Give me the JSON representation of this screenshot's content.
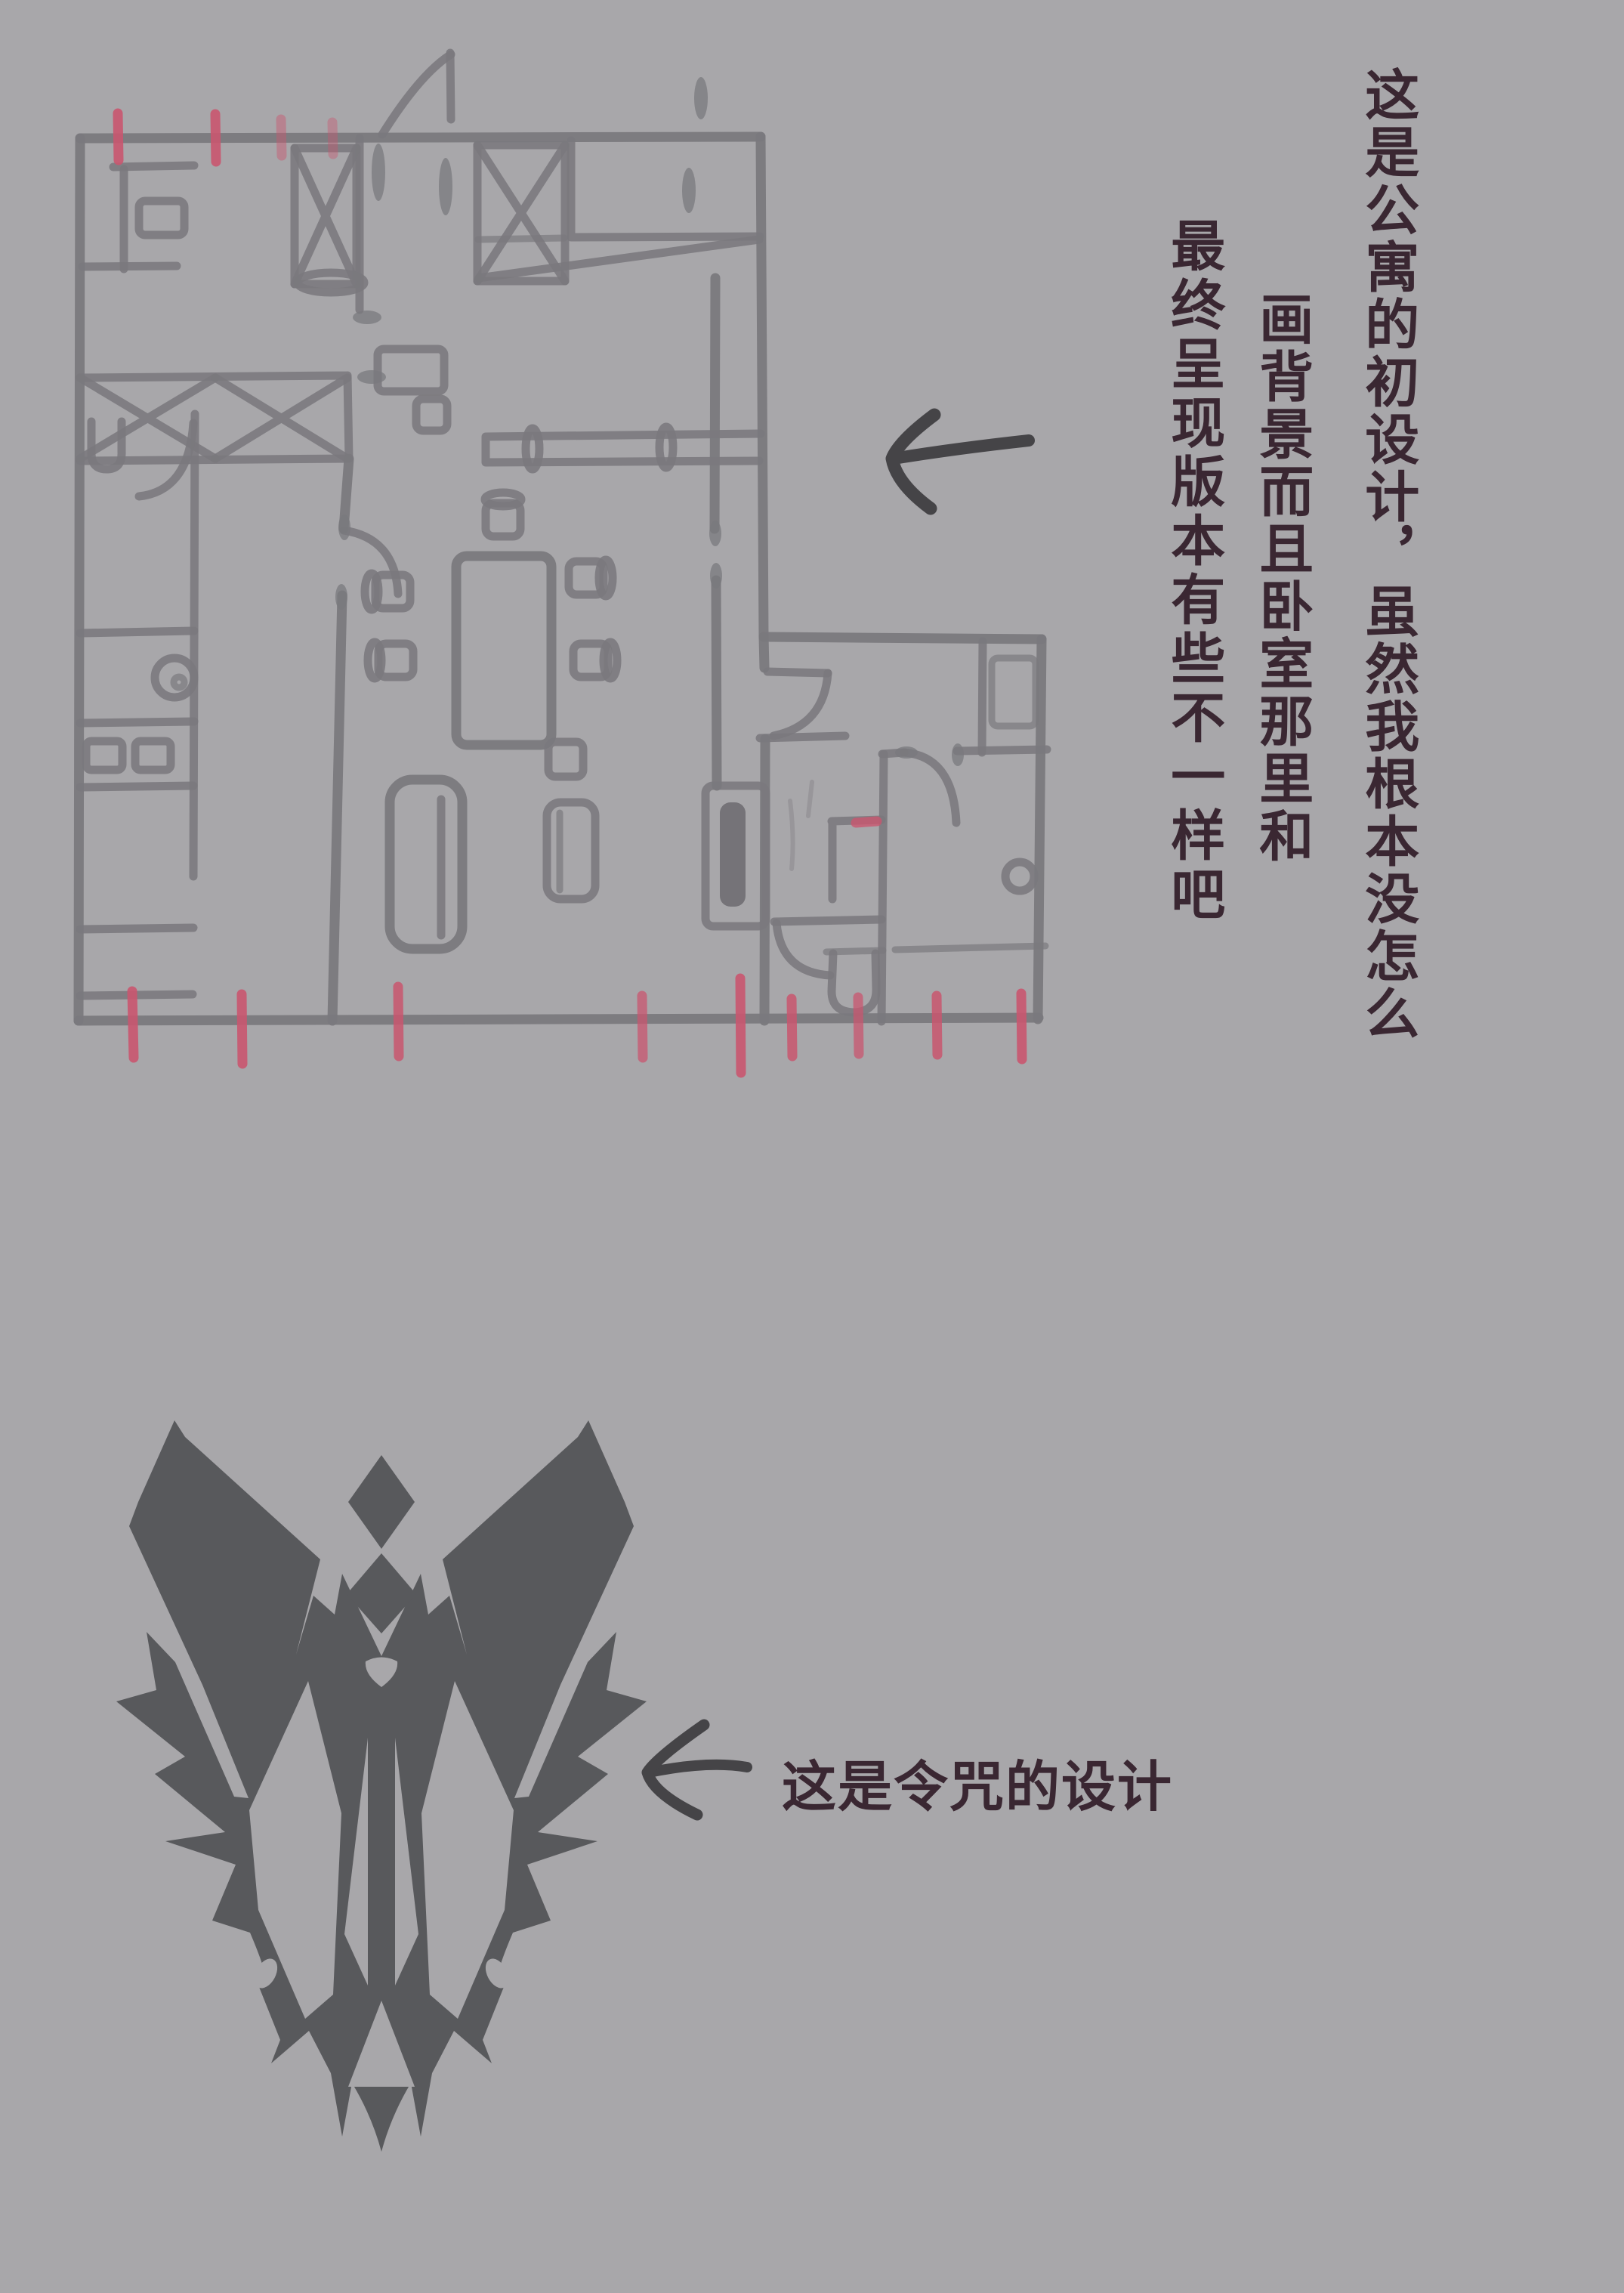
{
  "notes": {
    "col1": "这是公寓的初设计，虽然我根本没怎么",
    "col2": "画背景而且卧室那里和",
    "col3": "最终呈现版本有些不一样吧",
    "seal_caption": "这是令咒的设计"
  },
  "palette": {
    "background": "#a8a7aa",
    "sketch_ink": "#7a797d",
    "dark_ink": "#454447",
    "note_text": "#3a2732",
    "marker_pink": "#c9566f",
    "emblem_gray": "#58595c"
  },
  "icons": {
    "plan_arrow": "left-arrow",
    "seal_arrow": "left-arrow"
  }
}
